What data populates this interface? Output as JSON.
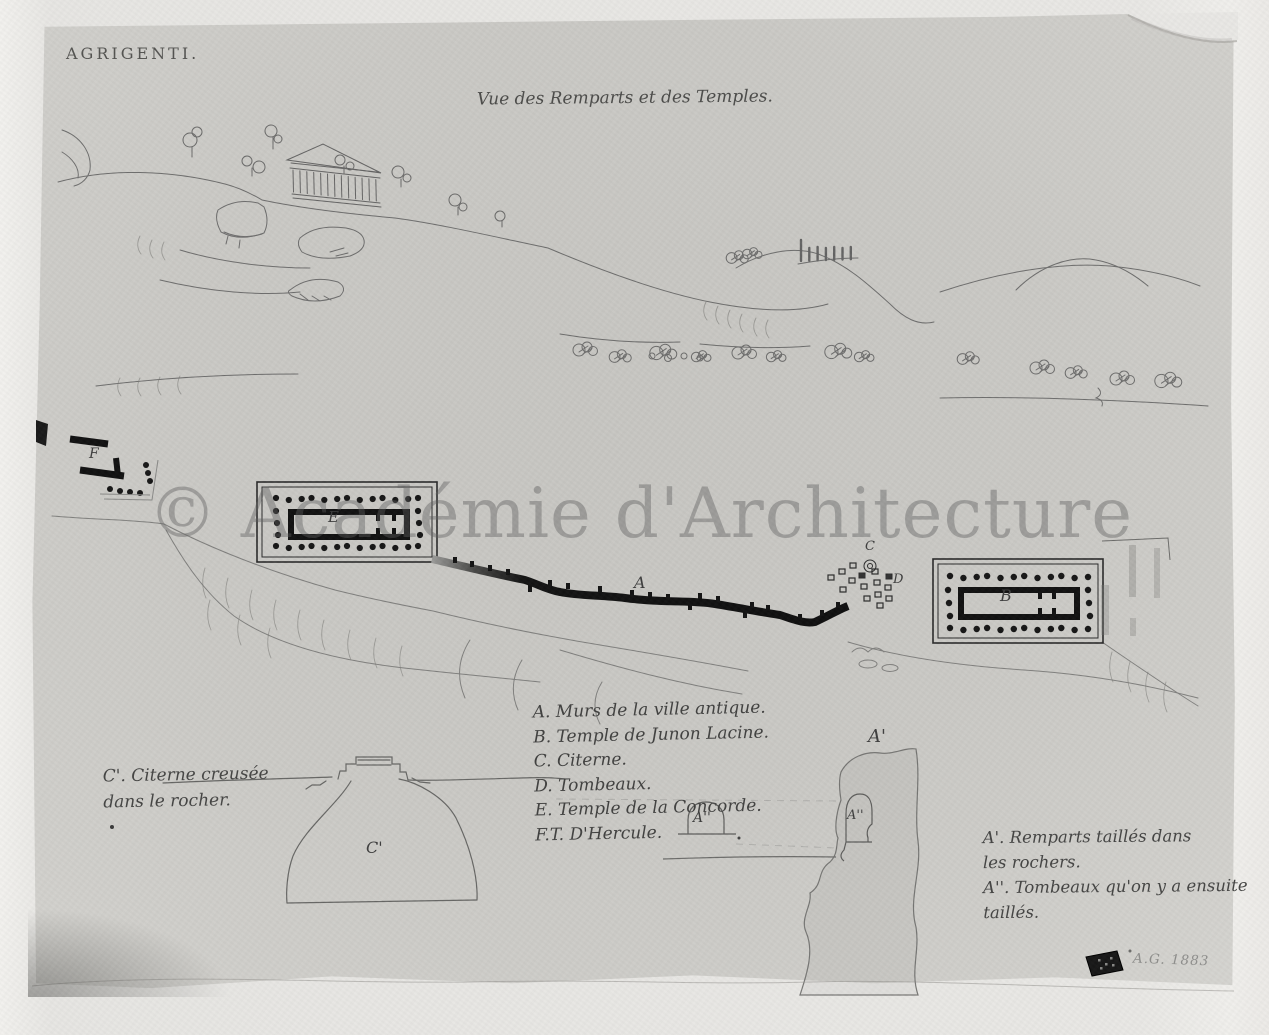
{
  "artwork": {
    "title": "AGRIGENTI.",
    "caption": "Vue des Remparts et des Temples.",
    "watermark": "© Académie d'Architecture",
    "signature": "A.G. 1883"
  },
  "legend": {
    "items": [
      "A. Murs de la ville antique.",
      "B. Temple de Junon Lacine.",
      "C. Citerne.",
      "D. Tombeaux.",
      "E. Temple de la Concorde.",
      "F.T. D'Hercule."
    ]
  },
  "notes": {
    "cistern": [
      "C'. Citerne creusée",
      "dans le rocher."
    ],
    "ramparts": [
      "A'. Remparts taillés dans",
      "les rochers.",
      "A''. Tombeaux qu'on y a ensuite",
      "taillés."
    ]
  },
  "plan_labels": {
    "wall": "A",
    "temple_concorde": "E",
    "temple_junon": "B",
    "temple_hercule": "F",
    "cistern_symbol": "C",
    "tombs": "D",
    "cistern_section": "C'",
    "rampart_section": "A'",
    "tomb_arch": "A''",
    "tomb_niche": "A''"
  },
  "colors": {
    "mount": "#e9e8e5",
    "paper": "#cac9c5",
    "ink": "#161616",
    "pencil": "#5a5a5a",
    "watermark": "#606060"
  }
}
